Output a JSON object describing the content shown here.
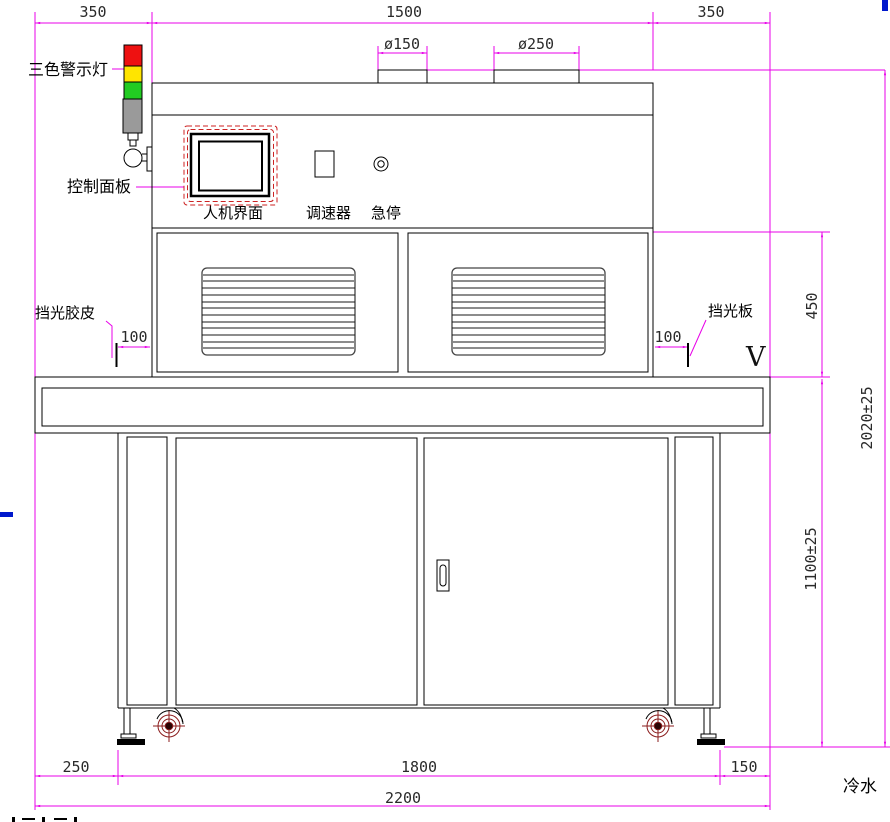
{
  "drawing": {
    "type": "equipment-front-view-engineering-drawing",
    "labels": {
      "warning_light": "三色警示灯",
      "control_panel": "控制面板",
      "hmi": "人机界面",
      "speed_controller": "调速器",
      "emergency_stop": "急停",
      "light_shield_rubber": "挡光胶皮",
      "light_shield_plate": "挡光板",
      "cold_water": "冷水",
      "view_marker": "V"
    },
    "dimensions": {
      "top_left_overhang": "350",
      "body_width": "1500",
      "top_right_overhang": "350",
      "duct_small_diameter": "ø150",
      "duct_large_diameter": "ø250",
      "hood_section_height": "450",
      "overall_height": "2020±25",
      "table_height": "1100±25",
      "rubber_offset_left": "100",
      "plate_offset_right": "100",
      "bottom_left_offset": "250",
      "leg_span": "1800",
      "bottom_right_offset": "150",
      "overall_length": "2200"
    },
    "colors": {
      "dimension_line": "#e800e8",
      "outline": "#000000",
      "lamp_red": "#ee1111",
      "lamp_yellow": "#ffe500",
      "lamp_green": "#22cc22",
      "lamp_gray": "#9a9a9a",
      "hmi_dashed_border": "#cc2222",
      "caster_accent": "#8b1d1d",
      "artifact_blue": "#0018cc"
    }
  }
}
